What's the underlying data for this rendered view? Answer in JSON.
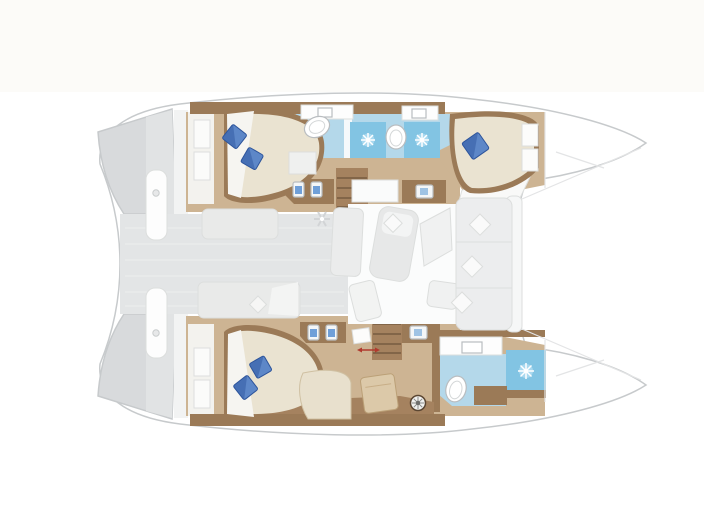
{
  "meta": {
    "type": "floor-plan",
    "subject": "catamaran-yacht-interior-layout",
    "view": "top-down",
    "orientation": "bow-right",
    "cabins_visible": 3,
    "bathrooms_visible": 3
  },
  "colors": {
    "background": "#ffffff",
    "paper_tint": "#faf8f3",
    "hull_fill": "#ffffff",
    "hull_outline": "#c7cacc",
    "deck_gray": "#e3e5e6",
    "stern_step_gray": "#d8dadc",
    "stern_step_light": "#e1e3e4",
    "wood_dark": "#9b7a57",
    "wood_mid": "#a5825f",
    "wood_floor": "#cdb493",
    "bed_cream": "#eae3d1",
    "chaise_cream": "#e8e0cd",
    "ottoman_tan": "#dcc9a9",
    "pillow_blue": "#5d87c8",
    "pillow_blue_dark": "#2f57a0",
    "bath_floor_blue": "#b4d8ea",
    "shower_blue": "#82c4e3",
    "fixture_white": "#ffffff",
    "furniture_light": "#eaebeb",
    "saloon_floor": "#fbfcfc",
    "accent_red": "#b03a2e"
  },
  "icons": [
    {
      "name": "shower-jet-icon",
      "meaning": "shower spray starburst",
      "count": 3
    },
    {
      "name": "toilet-icon",
      "meaning": "toilet bowl",
      "count": 3
    },
    {
      "name": "sink-icon",
      "meaning": "wash basin",
      "count": 7
    },
    {
      "name": "pillow-icon",
      "meaning": "blue bed pillow",
      "count": 5
    },
    {
      "name": "helm-wheel-icon",
      "meaning": "steering wheel",
      "count": 1
    },
    {
      "name": "vent-icon",
      "meaning": "ceiling vent / fan",
      "count": 1
    },
    {
      "name": "dimension-arrow-icon",
      "meaning": "small red dimension mark",
      "count": 1
    }
  ],
  "regions": [
    "swim-platform-port",
    "swim-platform-starboard",
    "aft-cockpit-deck",
    "port-aft-cabin",
    "port-bathroom-aft",
    "port-bathroom-forward",
    "port-forward-cabin",
    "saloon",
    "galley-counters",
    "companionway-stairs-port",
    "companionway-stairs-starboard",
    "starboard-aft-cabin",
    "owner-lounge",
    "owner-bathroom",
    "forward-cockpit-bench",
    "bow-port",
    "bow-starboard"
  ]
}
